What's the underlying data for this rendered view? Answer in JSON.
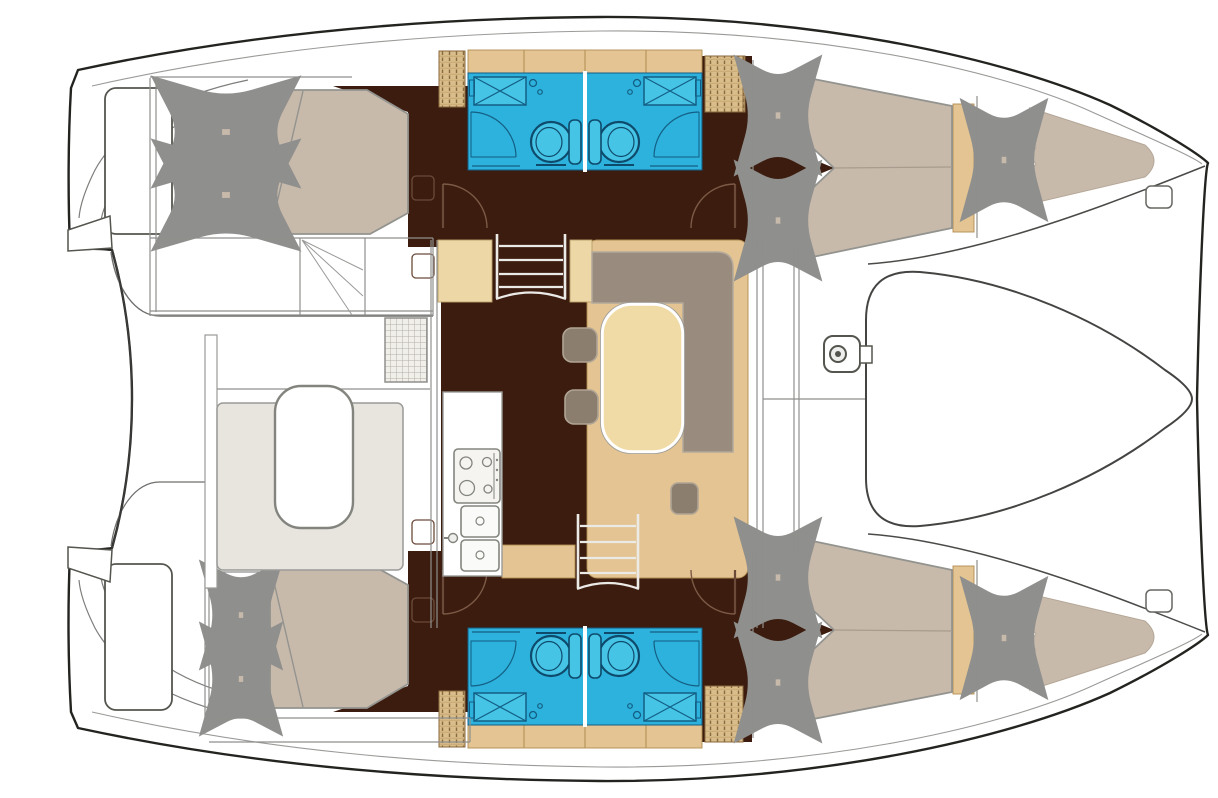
{
  "meta": {
    "title": "Catamaran interior layout floor plan, top-down view, bow to the right",
    "diagram_type": "boat-floor-plan"
  },
  "palette": {
    "hull_outline": "#232320",
    "line_gray": "#8f8f8d",
    "line_light": "#b9b6b0",
    "floor_dark": "#3b1c0e",
    "cabinet_tan": "#e3c492",
    "cabinet_tan_light": "#eed7a6",
    "locker_tan": "#d9bd8a",
    "hatch_brown": "#8a6a3f",
    "mattress_taupe": "#c8baab",
    "mattress_stroke": "#93938f",
    "sofa_taupe": "#998b7e",
    "stool_taupe": "#8c7e6e",
    "table_cream": "#f0dba6",
    "bathroom_cyan": "#2cb2dc",
    "bathroom_cyan_light": "#45c4e6",
    "bathroom_line": "#145e84",
    "bench_greige": "#e8e5df",
    "white": "#ffffff"
  },
  "rooms": {
    "aft_cabin_top": {
      "label": "Aft double cabin (upper hull) with mattress and two pillows"
    },
    "aft_cabin_bottom": {
      "label": "Aft double cabin (lower hull) with mattress and two pillows"
    },
    "head_top": {
      "label": "Two bathrooms with toilet, sink and shower (upper hull)"
    },
    "head_bottom": {
      "label": "Two bathrooms with toilet, sink and shower (lower hull)"
    },
    "fwd_cabin_top": {
      "label": "Forward double cabin (upper hull)"
    },
    "fwd_cabin_bottom": {
      "label": "Forward double cabin (lower hull)"
    },
    "forepeak_top": {
      "label": "Forepeak berth (upper bow)"
    },
    "forepeak_bottom": {
      "label": "Forepeak berth (lower bow)"
    },
    "saloon": {
      "label": "Saloon with L-shaped sofa, oval table and two stools"
    },
    "galley": {
      "label": "Galley with stove and double sink"
    },
    "cockpit": {
      "label": "Aft cockpit with bench and table"
    },
    "foredeck": {
      "label": "Foredeck and trampoline between the bows"
    },
    "stern_platforms": {
      "label": "Transom steps and swim platforms"
    }
  },
  "features": {
    "double_beds": 4,
    "forepeak_berths": 2,
    "toilets": 4,
    "sinks_bathroom": 4,
    "showers": 4,
    "saloon_tables": 1,
    "stools": 3,
    "companionway_steps": 2,
    "stove_burners": 4,
    "galley_sinks": 2,
    "cockpit_tables": 1,
    "windlass": 1,
    "bow_cleats": 2
  }
}
